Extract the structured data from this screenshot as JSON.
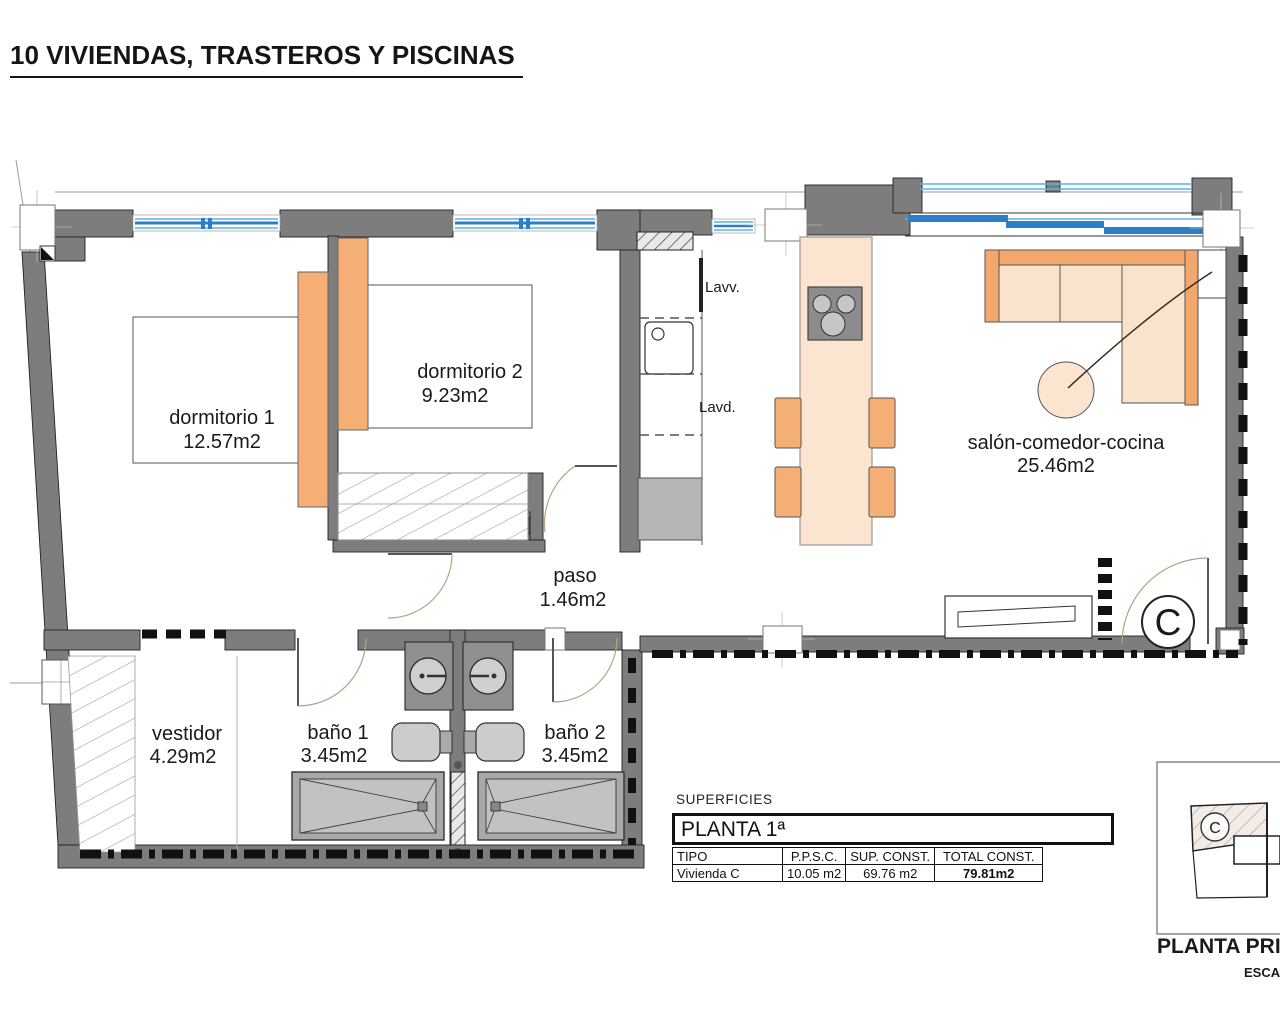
{
  "title": "10 VIVIENDAS, TRASTEROS Y PISCINAS",
  "plan": {
    "rooms": [
      {
        "name": "dormitorio 1",
        "area": "12.57m2"
      },
      {
        "name": "dormitorio 2",
        "area": "9.23m2"
      },
      {
        "name": "paso",
        "area": "1.46m2"
      },
      {
        "name": "vestidor",
        "area": "4.29m2"
      },
      {
        "name": "baño 1",
        "area": "3.45m2"
      },
      {
        "name": "baño 2",
        "area": "3.45m2"
      },
      {
        "name": "salón-comedor-cocina",
        "area": "25.46m2"
      }
    ],
    "appliance_labels": {
      "lavv": "Lavv.",
      "lavd": "Lavd."
    },
    "unit_letter": "C"
  },
  "surfaces": {
    "caption": "SUPERFICIES",
    "floor_header": "PLANTA 1ª",
    "columns": [
      "TIPO",
      "P.P.S.C.",
      "SUP. CONST.",
      "TOTAL CONST."
    ],
    "rows": [
      [
        "Vivienda C",
        "10.05 m2",
        "69.76 m2",
        "79.81m2"
      ]
    ]
  },
  "key_plan": {
    "unit_letter": "C",
    "title": "PLANTA PRIM",
    "subtitle": "ESCAL"
  },
  "colors": {
    "wall_gray": "#7d7d7d",
    "window_blue": "#2980c9",
    "window_blue_light": "#5fb0e2",
    "furniture_orange": "#f5ae74",
    "furniture_peach": "#fbe5d0"
  }
}
